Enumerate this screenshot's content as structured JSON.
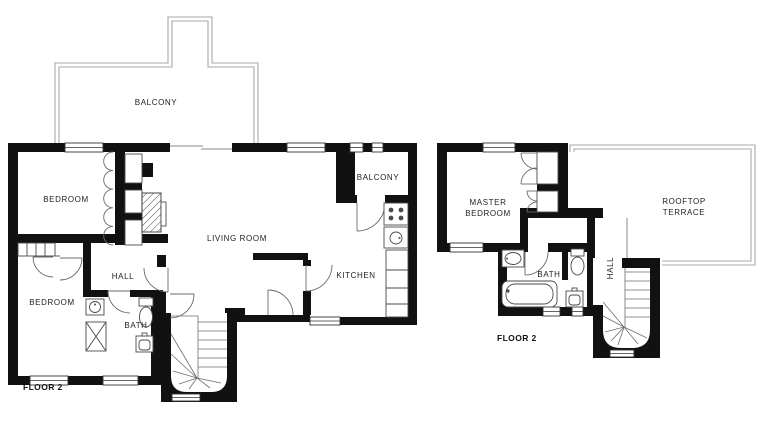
{
  "title": "Apartment floor plans - Floor 2",
  "colors": {
    "wall": "#111111",
    "fixture_line": "#4a4a4a",
    "door_line": "#6a6a6a",
    "railing_gray": "#a8a8a8",
    "text": "#222222",
    "background": "#ffffff"
  },
  "left_plan": {
    "floor_label": "FLOOR 2",
    "labels": {
      "balcony_top": "BALCONY",
      "bedroom_upper": "BEDROOM",
      "bedroom_lower": "BEDROOM",
      "hall": "HALL",
      "bath": "BATH",
      "living_room": "LIVING ROOM",
      "kitchen": "KITCHEN",
      "balcony_right": "BALCONY"
    }
  },
  "right_plan": {
    "floor_label": "FLOOR 2",
    "labels": {
      "master_line1": "MASTER",
      "master_line2": "BEDROOM",
      "bath": "BATH",
      "hall": "HALL",
      "terrace_line1": "ROOFTOP",
      "terrace_line2": "TERRACE"
    }
  }
}
